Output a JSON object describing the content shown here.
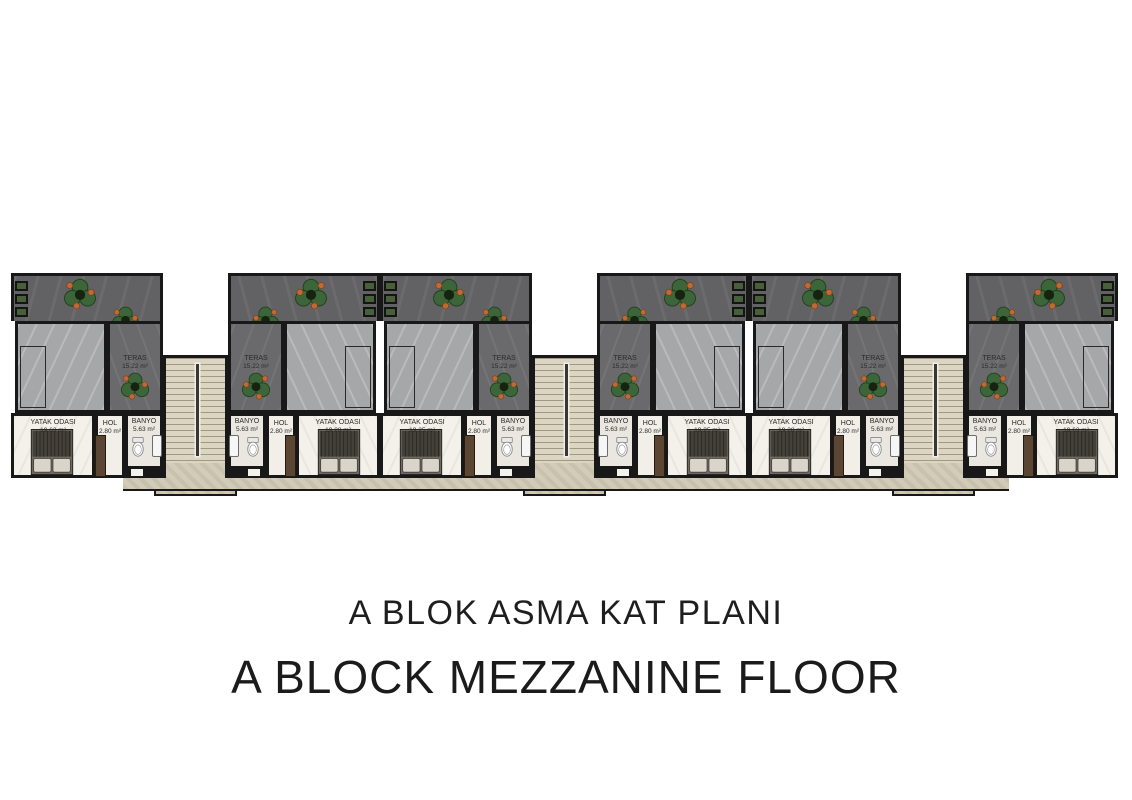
{
  "titles": {
    "line1": "A BLOK ASMA KAT PLANI",
    "line2": "A BLOCK MEZZANINE FLOOR"
  },
  "room_names": {
    "teras": "TERAS",
    "bedroom": "YATAK ODASI",
    "hall": "HOL",
    "bath": "BANYO"
  },
  "units": [
    {
      "name": "unit-1",
      "mirrored": false,
      "teras_area": "15.22 m²",
      "bedroom_area": "19.63 m²",
      "hall_area": "2.80 m²",
      "bath_area": "5.63 m²"
    },
    {
      "name": "unit-2",
      "mirrored": true,
      "teras_area": "15.22 m²",
      "bedroom_area": "19.28 m²",
      "hall_area": "2.80 m²",
      "bath_area": "5.63 m²"
    },
    {
      "name": "unit-3",
      "mirrored": false,
      "teras_area": "15.22 m²",
      "bedroom_area": "19.25 m²",
      "hall_area": "2.80 m²",
      "bath_area": "5.63 m²"
    },
    {
      "name": "unit-4",
      "mirrored": true,
      "teras_area": "15.22 m²",
      "bedroom_area": "19.25 m²",
      "hall_area": "2.80 m²",
      "bath_area": "5.63 m²"
    },
    {
      "name": "unit-5",
      "mirrored": false,
      "teras_area": "15.22 m²",
      "bedroom_area": "19.28 m²",
      "hall_area": "2.80 m²",
      "bath_area": "5.63 m²"
    },
    {
      "name": "unit-6",
      "mirrored": true,
      "teras_area": "15.22 m²",
      "bedroom_area": "19.63 m²",
      "hall_area": "2.80 m²",
      "bath_area": "5.63 m²"
    }
  ],
  "colors": {
    "wall": "#181818",
    "terrace_roof": "#626264",
    "teras_floor": "#6a6a6c",
    "void_room": "#a6a7a9",
    "room_floor": "#f3f1ea",
    "bath_floor": "#e9e7e0",
    "stair_beige": "#dcd5c2",
    "walkway_beige": "#d2cbb8",
    "plant_green": "#3c663a",
    "plant_orange": "#bf6a33",
    "wardrobe_brown": "#5b4634"
  }
}
